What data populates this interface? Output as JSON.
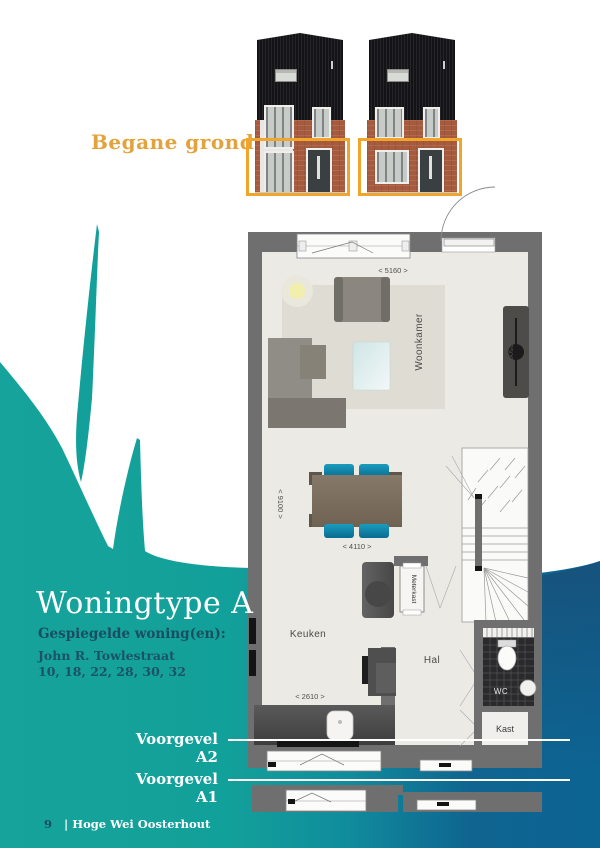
{
  "page": {
    "floor_label": "Begane grond",
    "title": "Woningtype A",
    "subtitle": "Gespiegelde woning(en):",
    "street": "John R. Towlestraat",
    "numbers": "10, 18, 22, 28, 30, 32",
    "footer": {
      "number": "9",
      "project": "| Hoge Wei Oosterhout"
    }
  },
  "sections": {
    "a2": "Voorgevel A2",
    "a1": "Voorgevel A1"
  },
  "plan": {
    "rooms": {
      "woonkamer": "Woonkamer",
      "keuken": "Keuken",
      "hal": "Hal",
      "wc": "WC",
      "kast": "Kast",
      "meterkast": "Meterkast"
    },
    "dims": {
      "d5160": "< 5160 >",
      "d3500": "< 3500 >",
      "d9100": "< 9100 >",
      "d4110": "< 4110 >",
      "d2610": "< 2610 >"
    }
  },
  "colors": {
    "teal": "#14A09A",
    "deep_blue": "#0D6392",
    "accent_orange": "#F1A62B",
    "text_orange": "#E2A23C",
    "wall_gray": "#6F6F6F"
  }
}
